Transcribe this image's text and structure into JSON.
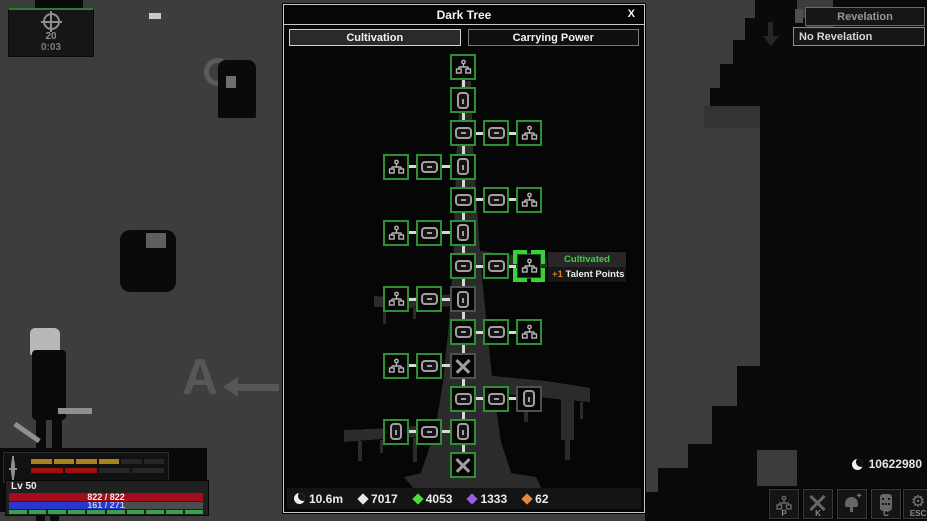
{
  "hud": {
    "wave_panel": {
      "counter": "20",
      "timer": "0:03"
    },
    "combat_meter": {
      "gold": {
        "filled": 4,
        "total": 6,
        "color": "#a8841f",
        "empty": "#262626"
      },
      "red": {
        "filled": 2,
        "total": 4,
        "color": "#9c1212",
        "empty": "#262626"
      }
    },
    "player_panel": {
      "level_label": "Lv 50",
      "hp": {
        "current": 822,
        "max": 822,
        "text": "822 / 822",
        "color": "#a50d1c"
      },
      "mp": {
        "current": 161,
        "max": 271,
        "text": "161 / 271",
        "color": "#2737d2"
      },
      "stamina": {
        "filled": 10,
        "total": 10,
        "color": "#37a04b"
      }
    },
    "hint_key": "A",
    "revelation": {
      "title": "Revelation",
      "status": "No Revelation"
    },
    "moon_currency": "10622980",
    "action_buttons": [
      {
        "label": "P",
        "icon": "talent-tree-icon"
      },
      {
        "label": "K",
        "icon": "crossed-swords-icon"
      },
      {
        "label": "",
        "icon": "bell-consumable-icon"
      },
      {
        "label": "C",
        "icon": "companion-icon"
      },
      {
        "label": "ESC",
        "icon": "gear-icon"
      }
    ]
  },
  "dialog": {
    "title": "Dark Tree",
    "close_label": "X",
    "tabs": [
      "Cultivation",
      "Carrying Power"
    ],
    "active_tab": 0,
    "tooltip": {
      "status": "Cultivated",
      "bonus": "+1",
      "bonus_label": " Talent Points",
      "status_color": "#3fd23f",
      "bonus_color": "#e07820"
    },
    "resources": [
      {
        "icon": "moon",
        "value": "10.6m",
        "color": "#f0f0f0"
      },
      {
        "icon": "diamond",
        "value": "7017",
        "color": "#e8e8e8"
      },
      {
        "icon": "diamond",
        "value": "4053",
        "color": "#4ade3a"
      },
      {
        "icon": "diamond",
        "value": "1333",
        "color": "#9a5ce0"
      },
      {
        "icon": "diamond",
        "value": "62",
        "color": "#e8883c"
      }
    ],
    "tree": {
      "colors": {
        "node_on": "#2f8f35",
        "node_off": "#505050",
        "selected_bracket": "#38d13a",
        "link": "#d8d8d8"
      },
      "nodes": [
        {
          "c": 2,
          "r": 1,
          "icon": "branch",
          "state": "on"
        },
        {
          "c": 2,
          "r": 2,
          "icon": "tall",
          "state": "on"
        },
        {
          "c": 2,
          "r": 3,
          "icon": "wide",
          "state": "on"
        },
        {
          "c": 3,
          "r": 3,
          "icon": "wide",
          "state": "on"
        },
        {
          "c": 4,
          "r": 3,
          "icon": "branch",
          "state": "on"
        },
        {
          "c": 0,
          "r": 4,
          "icon": "branch",
          "state": "on"
        },
        {
          "c": 1,
          "r": 4,
          "icon": "wide",
          "state": "on"
        },
        {
          "c": 2,
          "r": 4,
          "icon": "tall",
          "state": "on"
        },
        {
          "c": 2,
          "r": 5,
          "icon": "wide",
          "state": "on"
        },
        {
          "c": 3,
          "r": 5,
          "icon": "wide",
          "state": "on"
        },
        {
          "c": 4,
          "r": 5,
          "icon": "branch",
          "state": "on"
        },
        {
          "c": 0,
          "r": 6,
          "icon": "branch",
          "state": "on"
        },
        {
          "c": 1,
          "r": 6,
          "icon": "wide",
          "state": "on"
        },
        {
          "c": 2,
          "r": 6,
          "icon": "tall",
          "state": "on"
        },
        {
          "c": 2,
          "r": 7,
          "icon": "wide",
          "state": "on"
        },
        {
          "c": 3,
          "r": 7,
          "icon": "wide",
          "state": "on"
        },
        {
          "c": 4,
          "r": 7,
          "icon": "branch",
          "state": "sel"
        },
        {
          "c": 0,
          "r": 8,
          "icon": "branch",
          "state": "on"
        },
        {
          "c": 1,
          "r": 8,
          "icon": "wide",
          "state": "on"
        },
        {
          "c": 2,
          "r": 8,
          "icon": "tall",
          "state": "off"
        },
        {
          "c": 2,
          "r": 9,
          "icon": "wide",
          "state": "on"
        },
        {
          "c": 3,
          "r": 9,
          "icon": "wide",
          "state": "on"
        },
        {
          "c": 4,
          "r": 9,
          "icon": "branch",
          "state": "on"
        },
        {
          "c": 0,
          "r": 10,
          "icon": "branch",
          "state": "on"
        },
        {
          "c": 1,
          "r": 10,
          "icon": "wide",
          "state": "on"
        },
        {
          "c": 2,
          "r": 10,
          "icon": "cross",
          "state": "off"
        },
        {
          "c": 2,
          "r": 11,
          "icon": "wide",
          "state": "on"
        },
        {
          "c": 3,
          "r": 11,
          "icon": "wide",
          "state": "on"
        },
        {
          "c": 4,
          "r": 11,
          "icon": "tall",
          "state": "off"
        },
        {
          "c": 0,
          "r": 12,
          "icon": "tall",
          "state": "on"
        },
        {
          "c": 1,
          "r": 12,
          "icon": "wide",
          "state": "on"
        },
        {
          "c": 2,
          "r": 12,
          "icon": "tall",
          "state": "on"
        },
        {
          "c": 2,
          "r": 13,
          "icon": "cross",
          "state": "on"
        }
      ]
    }
  }
}
